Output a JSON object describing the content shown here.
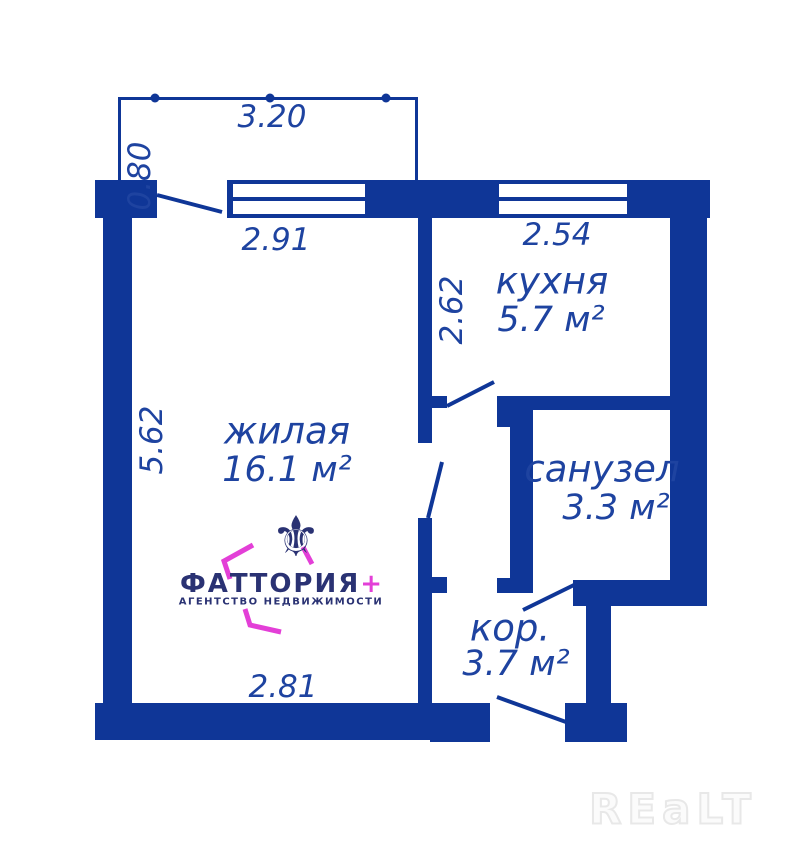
{
  "colors": {
    "wall_blue": "#0f3697",
    "label_blue": "#1e43a0",
    "logo_navy": "#2a3273",
    "logo_magenta": "#e33fd7",
    "watermark_gray": "#e8e8e8"
  },
  "rooms": {
    "living": {
      "name": "жилая",
      "area": "16.1 м²"
    },
    "kitchen": {
      "name": "кухня",
      "area": "5.7 м²"
    },
    "bathroom": {
      "name": "санузел",
      "area": "3.3 м²"
    },
    "corridor": {
      "name": "кор.",
      "area": "3.7 м²"
    }
  },
  "dimensions": {
    "balcony_width": "3.20",
    "balcony_depth": "0.80",
    "living_top": "2.91",
    "kitchen_top": "2.54",
    "kitchen_left": "2.62",
    "living_left": "5.62",
    "living_bottom": "2.81"
  },
  "logo": {
    "icon_glyph": "⚜",
    "brand": "ФАТТОРИЯ",
    "plus": "+",
    "tagline": "АГЕНТСТВО НЕДВИЖИМОСТИ"
  },
  "watermark": {
    "text": "REaLT"
  }
}
